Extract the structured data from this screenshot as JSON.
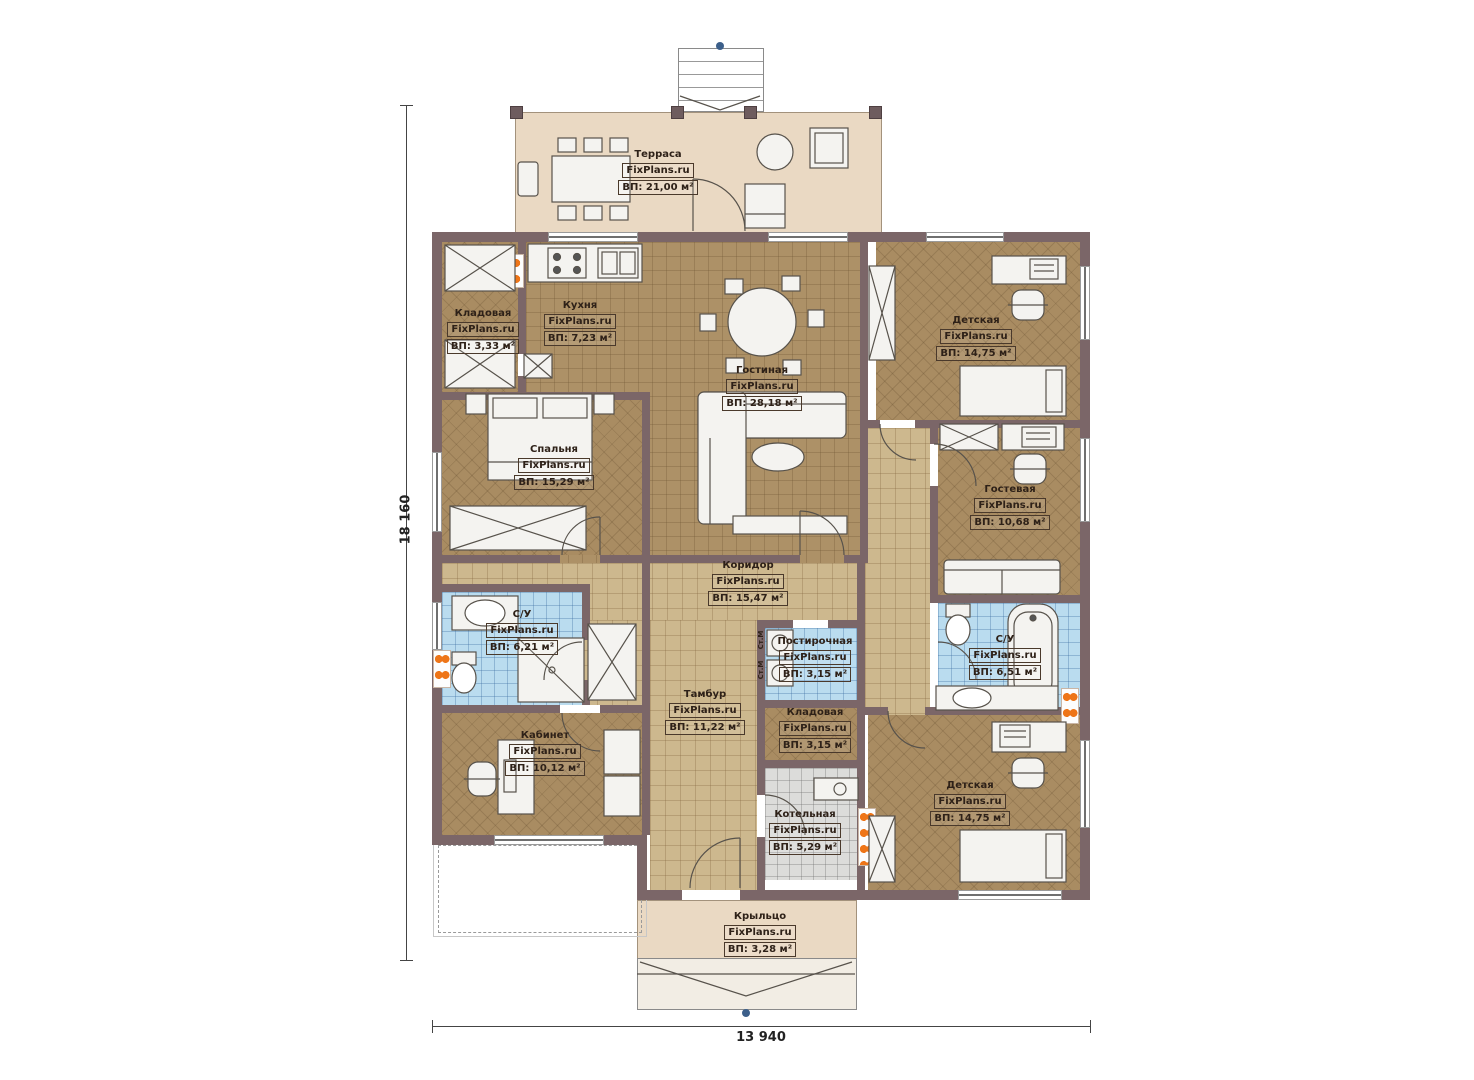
{
  "plan": {
    "dimensions": {
      "height": "18 160",
      "width": "13 940"
    },
    "labels": {
      "washer": "Ст.М"
    },
    "rooms": {
      "terrace": {
        "name": "Терраса",
        "watermark": "FixPlans.ru",
        "area": "ВП: 21,00 м²"
      },
      "pantry_top": {
        "name": "Кладовая",
        "watermark": "FixPlans.ru",
        "area": "ВП: 3,33 м²"
      },
      "kitchen": {
        "name": "Кухня",
        "watermark": "FixPlans.ru",
        "area": "ВП: 7,23 м²"
      },
      "living": {
        "name": "Гостиная",
        "watermark": "FixPlans.ru",
        "area": "ВП: 28,18 м²"
      },
      "kids_top": {
        "name": "Детская",
        "watermark": "FixPlans.ru",
        "area": "ВП: 14,75 м²"
      },
      "bedroom": {
        "name": "Спальня",
        "watermark": "FixPlans.ru",
        "area": "ВП: 15,29 м²"
      },
      "guest": {
        "name": "Гостевая",
        "watermark": "FixPlans.ru",
        "area": "ВП: 10,68 м²"
      },
      "corridor": {
        "name": "Коридор",
        "watermark": "FixPlans.ru",
        "area": "ВП: 15,47 м²"
      },
      "bath_left": {
        "name": "С/У",
        "watermark": "FixPlans.ru",
        "area": "ВП: 6,21 м²"
      },
      "laundry": {
        "name": "Постирочная",
        "watermark": "FixPlans.ru",
        "area": "ВП: 3,15 м²"
      },
      "vestibule": {
        "name": "Тамбур",
        "watermark": "FixPlans.ru",
        "area": "ВП: 11,22 м²"
      },
      "pantry_bottom": {
        "name": "Кладовая",
        "watermark": "FixPlans.ru",
        "area": "ВП: 3,15 м²"
      },
      "bath_right": {
        "name": "С/У",
        "watermark": "FixPlans.ru",
        "area": "ВП: 6,51 м²"
      },
      "office": {
        "name": "Кабинет",
        "watermark": "FixPlans.ru",
        "area": "ВП: 10,12 м²"
      },
      "boiler": {
        "name": "Котельная",
        "watermark": "FixPlans.ru",
        "area": "ВП: 5,29 м²"
      },
      "kids_bottom": {
        "name": "Детская",
        "watermark": "FixPlans.ru",
        "area": "ВП: 14,75 м²"
      },
      "porch": {
        "name": "Крыльцо",
        "watermark": "FixPlans.ru",
        "area": "ВП: 3,28 м²"
      }
    },
    "colors": {
      "wall": "#7b6668",
      "floor_brown": "#ad9167",
      "floor_tan": "#cdb88e",
      "floor_blue": "#badcef",
      "floor_grey": "#dcdcda",
      "terrace": "#ead9c3",
      "radiator": "#ee7518"
    }
  }
}
